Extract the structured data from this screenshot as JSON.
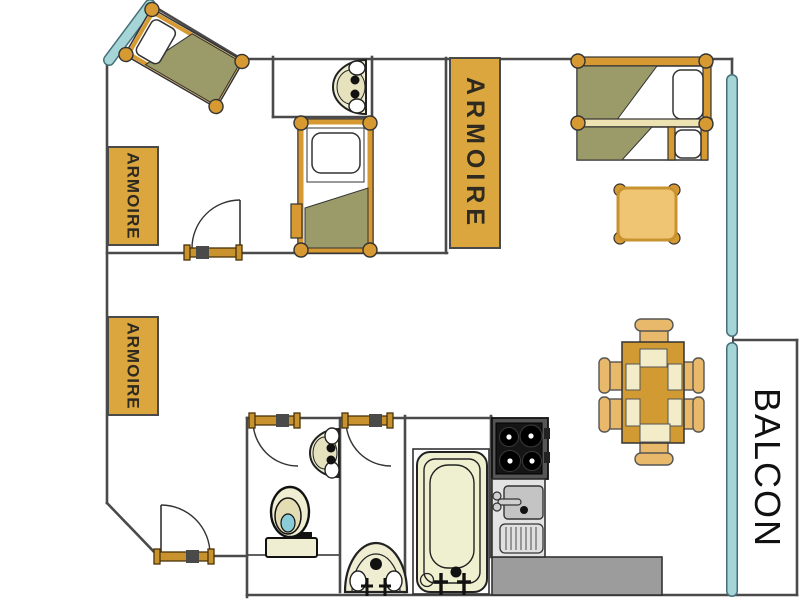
{
  "plan": {
    "labels": {
      "armoire_top_left": "ARMOIRE",
      "armoire_bottom_left": "ARMOIRE",
      "armoire_center": "ARMOIRE",
      "balcony": "BALCON"
    },
    "colors": {
      "furniture_amber": "#D79A32",
      "furniture_light": "#EFC573",
      "wardrobe_fill": "#DCA63F",
      "bedding_olive": "#9A9B69",
      "fixture_cream": "#EFEDD2",
      "window_teal": "#A5D5D6",
      "wall_gray": "#4a4a4a",
      "counter_gray": "#9C9C9C",
      "water_teal": "#8CCCD8",
      "stove_black": "#151515"
    }
  }
}
